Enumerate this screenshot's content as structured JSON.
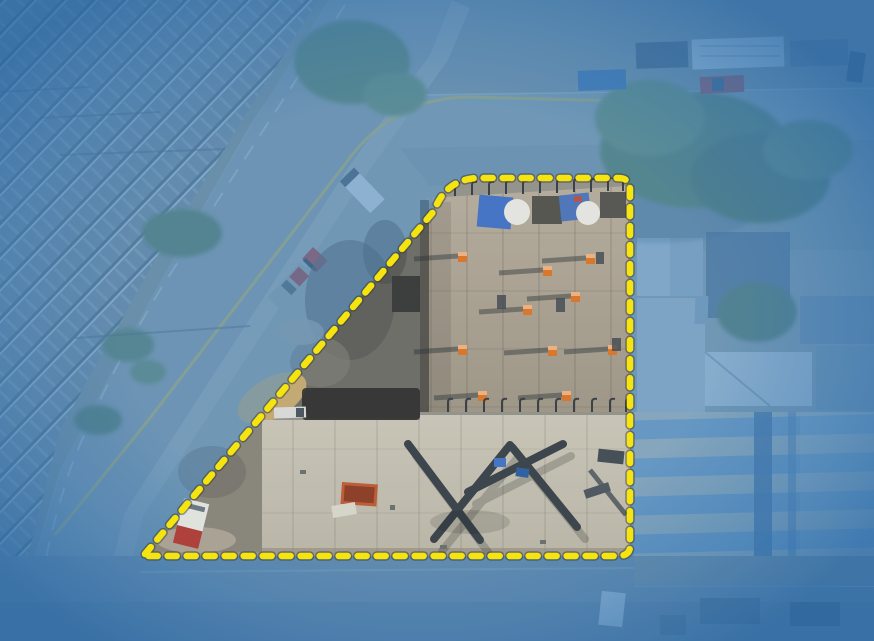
{
  "scene": {
    "kind": "aerial-drone-photo",
    "subject": "construction-site-property-with-highlighted-parcel",
    "surroundings": [
      "railroad-tracks",
      "curving-street",
      "trees",
      "neighboring-buildings",
      "parked-vehicles"
    ]
  },
  "colors": {
    "boundary_yellow": "#f6e40e",
    "boundary_halo": "#3c3c30",
    "overlay_blue": "#4a8cc8",
    "vignette_blue": "#2b6cab",
    "base_ground": "#9aa19e",
    "rail_bed": "#7d898e",
    "road_asphalt": "#929b9d",
    "street_bottom": "#7f8b93",
    "roof_upper": "#aca08e",
    "roof_lower": "#c7c0af",
    "debris_gray": "#6e6c64",
    "debris_light": "#8b8478",
    "char_black": "#2f2e2a",
    "sand_tan": "#c8a96e",
    "tree_green": "#5d7b4f",
    "tarp_blue": "#4472c4",
    "tank_white": "#e9e7e1",
    "cap_orange": "#df7524",
    "truck_red": "#b23b33",
    "rv_white": "#dde1e0",
    "pickup_blue": "#3e6ea8",
    "stripe_beige": "#c7c2b0",
    "stripe_blue": "#84a3bd",
    "equipment_dark": "#3a4046",
    "road_yellow_line": "#cdb84e"
  },
  "boundary": {
    "path": "M 145 554 L 434 211 Q 446 179 478 178 L 618 178 Q 630 178 630 189 L 630 546 Q 630 556 618 556 L 150 556 Q 145 556 145 554 Z",
    "dash": "9 10",
    "stroke_width": 6.5,
    "halo_width": 9.5,
    "overlay_opacity": 0.52
  }
}
